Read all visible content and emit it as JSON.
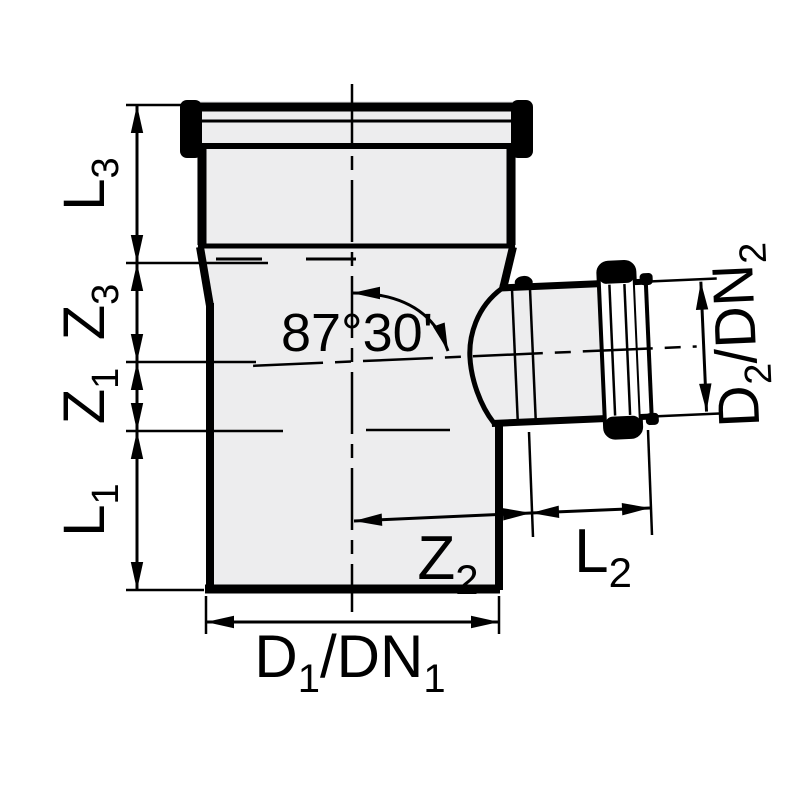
{
  "drawing": {
    "title": "Technical dimension drawing of an 87°30' single branch pipe fitting (tee) with sockets",
    "angle": {
      "label": "87°30'"
    },
    "dimensions": {
      "l3": {
        "base": "L",
        "sub": "3"
      },
      "z3": {
        "base": "Z",
        "sub": "3"
      },
      "z1": {
        "base": "Z",
        "sub": "1"
      },
      "l1": {
        "base": "L",
        "sub": "1"
      },
      "z2": {
        "base": "Z",
        "sub": "2"
      },
      "l2": {
        "base": "L",
        "sub": "2"
      },
      "d1dn1": {
        "base": "D",
        "sub": "1",
        "base2": "/DN",
        "sub2": "1"
      },
      "d2dn2": {
        "base": "D",
        "sub": "2",
        "base2": "/DN",
        "sub2": "2"
      }
    },
    "colors": {
      "line": "#000000",
      "body_fill": "#ededee",
      "socket_fill": "#ffffff",
      "background": "#ffffff"
    }
  }
}
